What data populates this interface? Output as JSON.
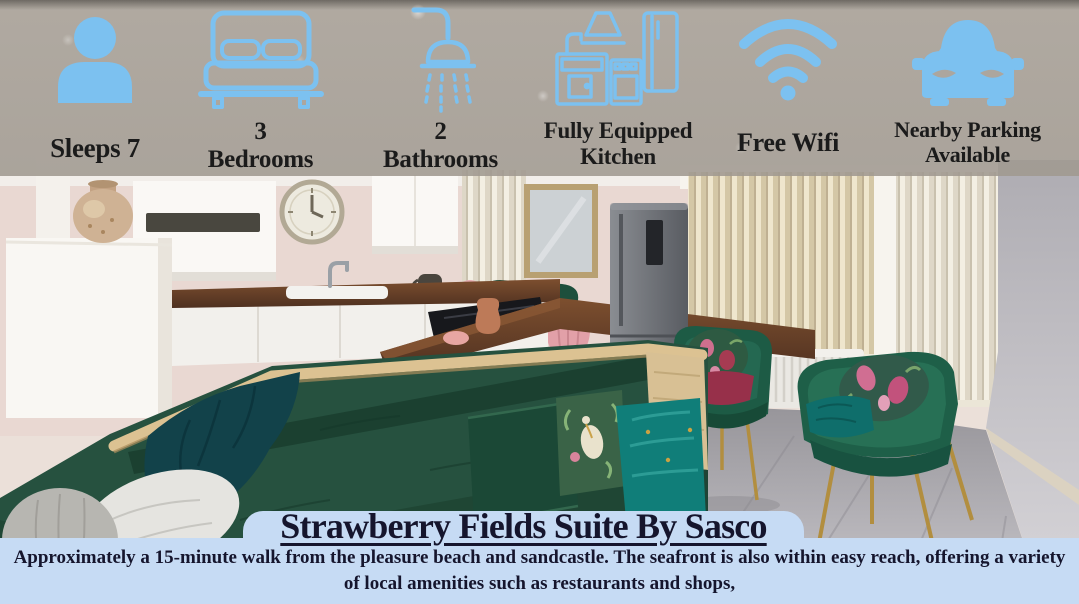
{
  "banner": {
    "features": [
      {
        "icon": "person-icon",
        "lines": [
          "Sleeps 7"
        ]
      },
      {
        "icon": "bed-icon",
        "lines": [
          "3",
          "Bedrooms"
        ]
      },
      {
        "icon": "shower-icon",
        "lines": [
          "2",
          "Bathrooms"
        ]
      },
      {
        "icon": "kitchen-icon",
        "lines": [
          "Fully Equipped",
          "Kitchen"
        ]
      },
      {
        "icon": "wifi-icon",
        "lines": [
          "Free Wifi"
        ]
      },
      {
        "icon": "car-icon",
        "lines": [
          "Nearby Parking",
          "Available"
        ]
      }
    ]
  },
  "panel": {
    "title": "Strawberry Fields Suite By Sasco",
    "description": "Approximately a 15-minute walk from the pleasure beach and sandcastle. The seafront is also within easy reach, offering a variety of local amenities such as restaurants and shops,"
  },
  "colors": {
    "icon_blue": "#7cc1f0",
    "panel_background": "#c6dbf4",
    "banner_text": "#1b1b1b",
    "panel_text": "#15152d"
  },
  "photo_alt": "Open-plan lounge and kitchen: green velvet corner sofa with patterned cushions, two green armchairs with gold legs, white kitchen units, wooden worktop, dark grey fridge, wall clock and cream vertical blinds"
}
